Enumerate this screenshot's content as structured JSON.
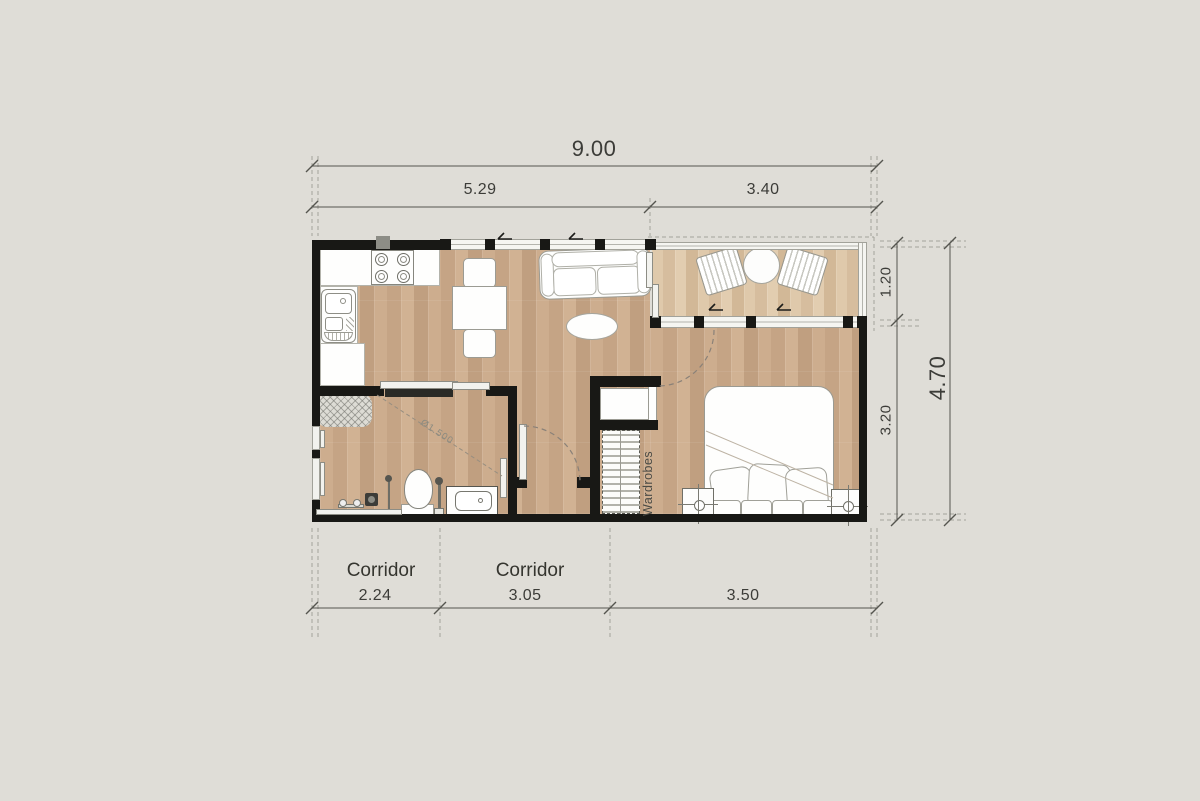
{
  "colors": {
    "background": "#dfddd7",
    "wall": "#181815",
    "wood_floor": "#c9a98a",
    "terrace_floor": "#dcc5a6",
    "dimension_line": "#55554f",
    "dimension_text": "#3c3c38"
  },
  "dimensions": {
    "top_total": "9.00",
    "top_segments": [
      "5.29",
      "3.40"
    ],
    "bottom_segments": [
      "2.24",
      "3.05",
      "3.50"
    ],
    "right_segments": [
      "1.20",
      "3.20"
    ],
    "right_total": "4.70"
  },
  "labels": {
    "corridor_1": "Corridor",
    "corridor_2": "Corridor",
    "wardrobes": "Wardrobes",
    "turning_radius": "Ø1.500"
  }
}
